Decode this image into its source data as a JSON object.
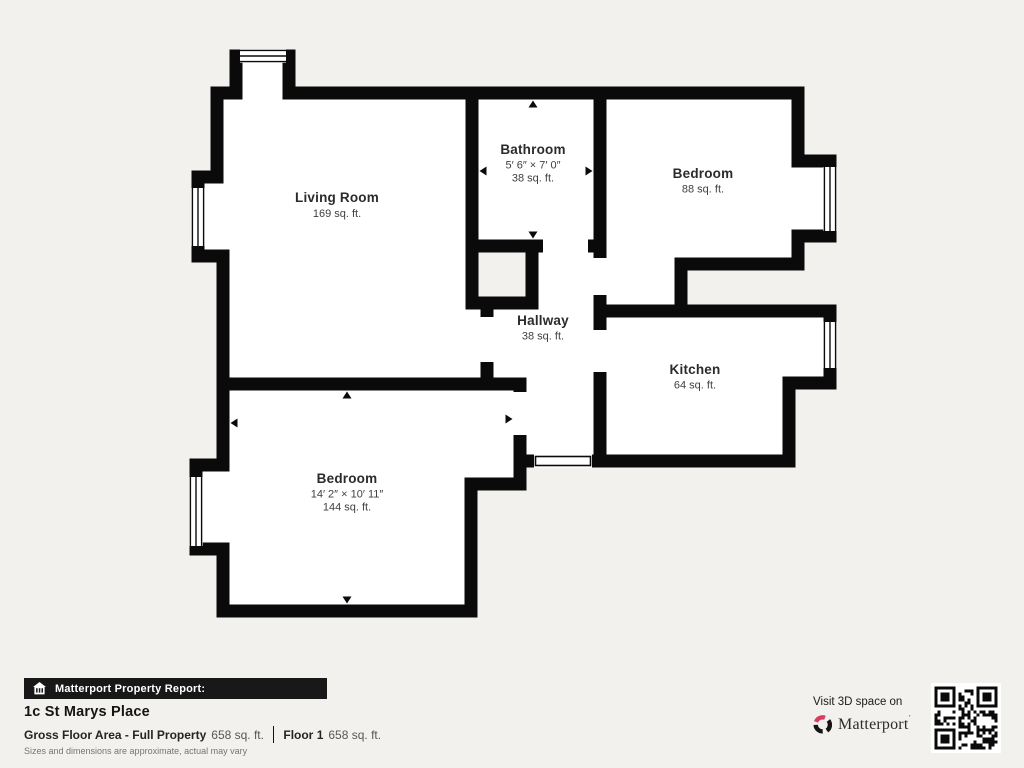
{
  "colors": {
    "background": "#f2f1ee",
    "wall": "#0a0a0a",
    "room_fill": "#ffffff",
    "brand_red": "#d93c60"
  },
  "rooms": {
    "living_room": {
      "name": "Living Room",
      "area": "169 sq. ft."
    },
    "bathroom": {
      "name": "Bathroom",
      "dimensions": "5′ 6″ × 7′ 0″",
      "area": "38 sq. ft."
    },
    "bedroom_top": {
      "name": "Bedroom",
      "area": "88 sq. ft."
    },
    "hallway": {
      "name": "Hallway",
      "area": "38 sq. ft."
    },
    "kitchen": {
      "name": "Kitchen",
      "area": "64 sq. ft."
    },
    "bedroom_bottom": {
      "name": "Bedroom",
      "dimensions": "14′ 2″ × 10′ 11″",
      "area": "144 sq. ft."
    }
  },
  "footer": {
    "report_banner": "Matterport Property Report:",
    "address": "1c St Marys Place",
    "gross_label": "Gross Floor Area - Full Property",
    "gross_value": "658 sq. ft.",
    "floor_label": "Floor 1",
    "floor_value": "658 sq. ft.",
    "disclaimer": "Sizes and dimensions are approximate, actual may vary"
  },
  "promo": {
    "visit_text": "Visit 3D space on",
    "brand": "Matterport"
  }
}
